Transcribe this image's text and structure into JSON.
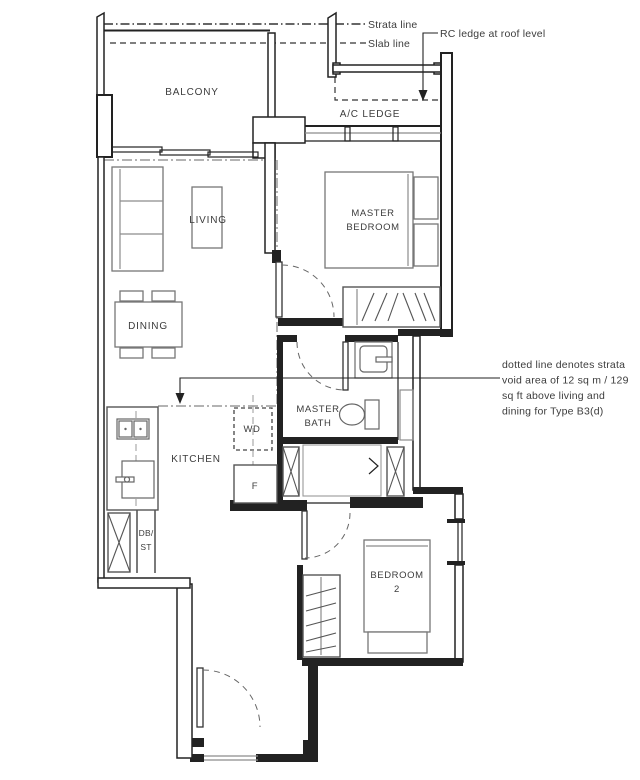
{
  "rooms": {
    "balcony": "BALCONY",
    "ac_ledge": "A/C LEDGE",
    "living": "LIVING",
    "dining": "DINING",
    "kitchen": "KITCHEN",
    "master_bedroom": {
      "line1": "MASTER",
      "line2": "BEDROOM"
    },
    "master_bath": {
      "line1": "MASTER",
      "line2": "BATH"
    },
    "bedroom2": {
      "line1": "BEDROOM",
      "line2": "2"
    },
    "washer_dryer": "WD",
    "fridge": "F",
    "db_store": {
      "line1": "DB/",
      "line2": "ST"
    }
  },
  "annotations": {
    "strata_line": "Strata line",
    "slab_line": "Slab line",
    "rc_ledge": "RC ledge at roof level",
    "strata_void": {
      "line1": "dotted line denotes strata",
      "line2": "void area of 12 sq m / 129",
      "line3": "sq ft above living and",
      "line4": "dining for Type B3(d)"
    }
  },
  "colors": {
    "wall": "#222222",
    "furniture": "#777777",
    "dash_gray": "#9a9a9a",
    "text": "#3c3c3c",
    "background": "#ffffff"
  }
}
